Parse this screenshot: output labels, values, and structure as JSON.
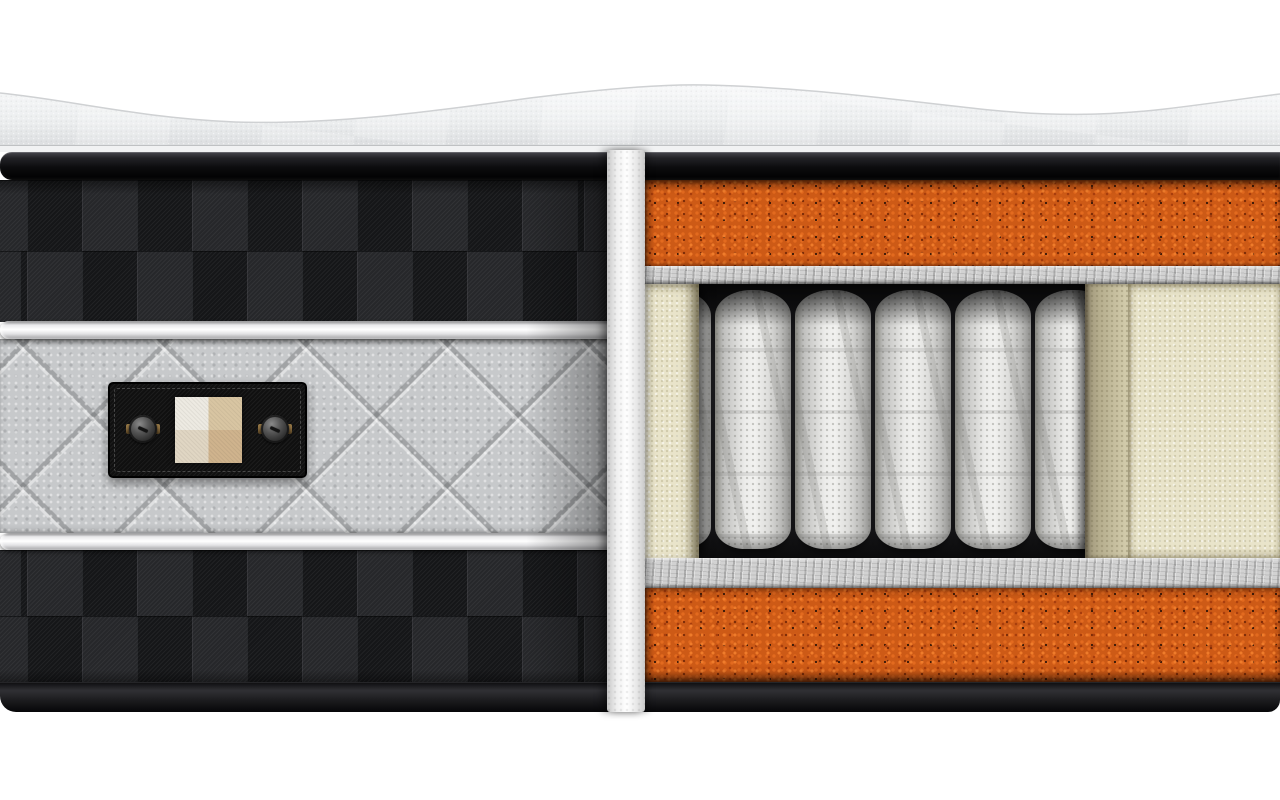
{
  "scene": {
    "type": "3d-product-render",
    "subject": "hybrid pocket-spring mattress cutaway",
    "description": "Cutaway render of a mattress: wavy white knit pillow top, black binding bands, black checkered side fabric with white piping cords and a gray diamond-quilted band holding a black riveted label tag with a four-quadrant fabric swatch; the exposed cross-section shows an orange speckled comfort foam layer, gray felt insulator pads, cream foam encasement rails and white fabric-wrapped pocket coil springs over a second orange foam base layer.",
    "visible_text": ""
  },
  "colors": {
    "background": "#ffffff",
    "border_band_highlight": "#47474d",
    "border_band_dark": "#0a0a0c",
    "check_square_light": "#26272a",
    "check_square_dark": "#151618",
    "piping_white": "#ffffff",
    "piping_shade": "#a8a8aa",
    "quilt_gray": "#c7c9cb",
    "label_black": "#101010",
    "label_stitch": "#6f6f6f",
    "rivet_gray": "#565656",
    "rivet_brass": "#8a6d3f",
    "swatch_top_left": "#edeae2",
    "swatch_top_right": "#d8c5a2",
    "swatch_bottom_left": "#e0d6c3",
    "swatch_bottom_right": "#cfb38d",
    "cut_fabric_white": "#f3f3f3",
    "foam_orange": "#cd5a16",
    "foam_orange_speck_light": "#ef7c2b",
    "foam_orange_speck_dark": "#7c2c08",
    "felt_gray": "#d2d2d2",
    "foam_cream": "#e9e4ca",
    "spring_fabric": "#ededeb",
    "spring_fabric_edge": "#8d8d8b",
    "cavity_shadow": "#1c1c1e"
  },
  "left_panel": {
    "sections": [
      {
        "name": "pillow-top",
        "material": "white knit quilted pillow top with wavy surface"
      },
      {
        "name": "top-border-band",
        "material": "black binding tape"
      },
      {
        "name": "checkered-fabric-top",
        "material": "black check weave fabric",
        "rows": 2
      },
      {
        "name": "white-piping-top",
        "material": "white piping cord"
      },
      {
        "name": "quilted-gray-band",
        "material": "gray diamond-quilted fabric"
      },
      {
        "name": "white-piping-bottom",
        "material": "white piping cord"
      },
      {
        "name": "checkered-fabric-bottom",
        "material": "black check weave fabric",
        "rows": 2
      },
      {
        "name": "bottom-border-band",
        "material": "black binding tape"
      }
    ],
    "label_tag": {
      "shape": "rounded rectangle with stitched inner border",
      "color": "black",
      "rivet_count": 2,
      "swatch_quadrants": 4
    }
  },
  "cross_section": {
    "spring_count": 7,
    "layers": [
      {
        "name": "comfort-foam-top",
        "material": "orange open-cell foam"
      },
      {
        "name": "felt-pad-top",
        "material": "gray felt insulator pad"
      },
      {
        "name": "pocket-spring-core",
        "material": "white fabric-wrapped pocket coils"
      },
      {
        "name": "foam-encasement-rails",
        "material": "cream polyurethane foam"
      },
      {
        "name": "felt-pad-bottom",
        "material": "gray felt insulator pad"
      },
      {
        "name": "comfort-foam-bottom",
        "material": "orange open-cell foam"
      }
    ]
  }
}
